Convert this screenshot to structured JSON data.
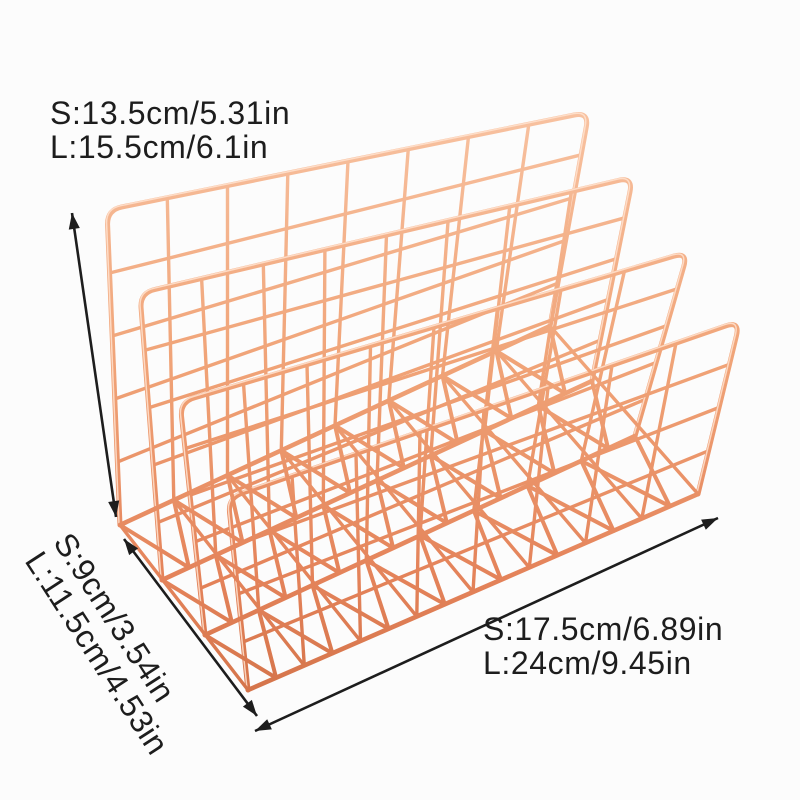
{
  "image": {
    "kind": "product dimension photo",
    "description": "Rose gold metal wire mesh desktop letter sorter / mail organizer with four grid panels forming three slots, annotated with black double-headed dimension arrows for height, depth and width",
    "background": "#fcfcfc"
  },
  "colors": {
    "copper_highlight": "#ffe3d0",
    "copper_light": "#f8c3a2",
    "copper_mid": "#f0a377",
    "copper_dark": "#e4835a",
    "copper_deep": "#cf6f45",
    "annotation": "#1d1d1d"
  },
  "product": {
    "name": "wire letter sorter",
    "finish": "rose gold",
    "panel_count": 4,
    "slot_count": 3
  },
  "dimensions": {
    "height": {
      "small": "S:13.5cm/5.31in",
      "large": "L:15.5cm/6.1in"
    },
    "depth": {
      "small": "S:9cm/3.54in",
      "large": "L:11.5cm/4.53in"
    },
    "width": {
      "small": "S:17.5cm/6.89in",
      "large": "L:24cm/9.45in"
    }
  }
}
